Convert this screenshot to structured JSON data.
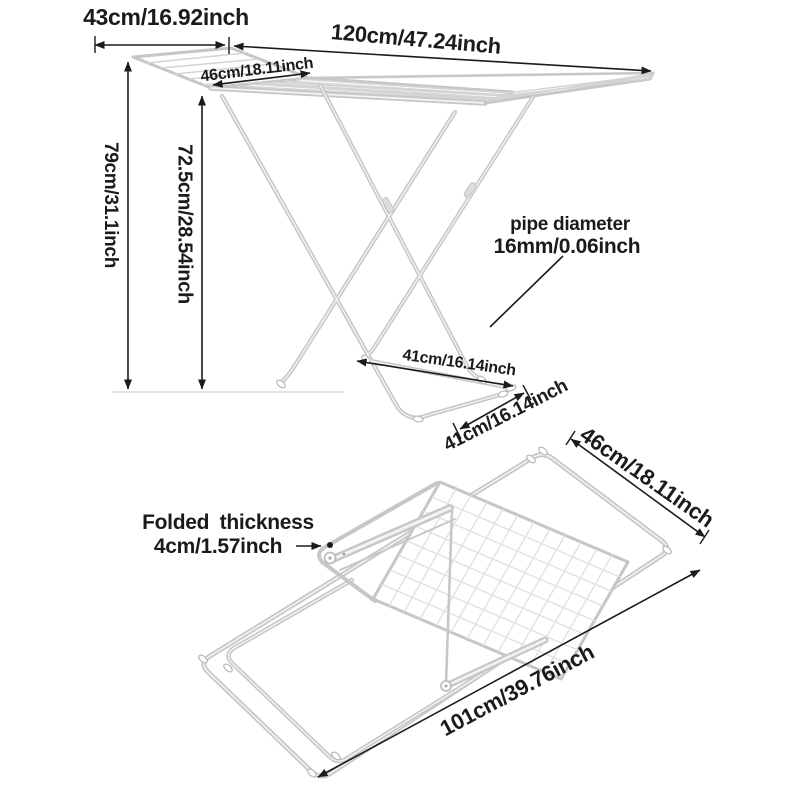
{
  "colors": {
    "background": "#ffffff",
    "text": "#1b1b1b",
    "dimension_line": "#1b1b1b",
    "tube_gray": "#c7c7c7",
    "mesh_gray": "#e0e0e0"
  },
  "unfolded_rack": {
    "labels": {
      "wing_width": "43cm/16.92inch",
      "total_width": "120cm/47.24inch",
      "panel_width": "46cm/18.11inch",
      "total_height": "79cm/31.1inch",
      "frame_height": "72.5cm/28.54inch",
      "pipe_note_line1": "pipe diameter",
      "pipe_note_line2": "16mm/0.06inch",
      "base_depth_rear": "41cm/16.14inch",
      "base_depth_front": "41cm/16.14inch"
    }
  },
  "folded_rack": {
    "labels": {
      "width": "46cm/18.11inch",
      "thickness_line1": "Folded thickness",
      "thickness_line2": "4cm/1.57inch",
      "length": "101cm/39.76inch"
    }
  }
}
